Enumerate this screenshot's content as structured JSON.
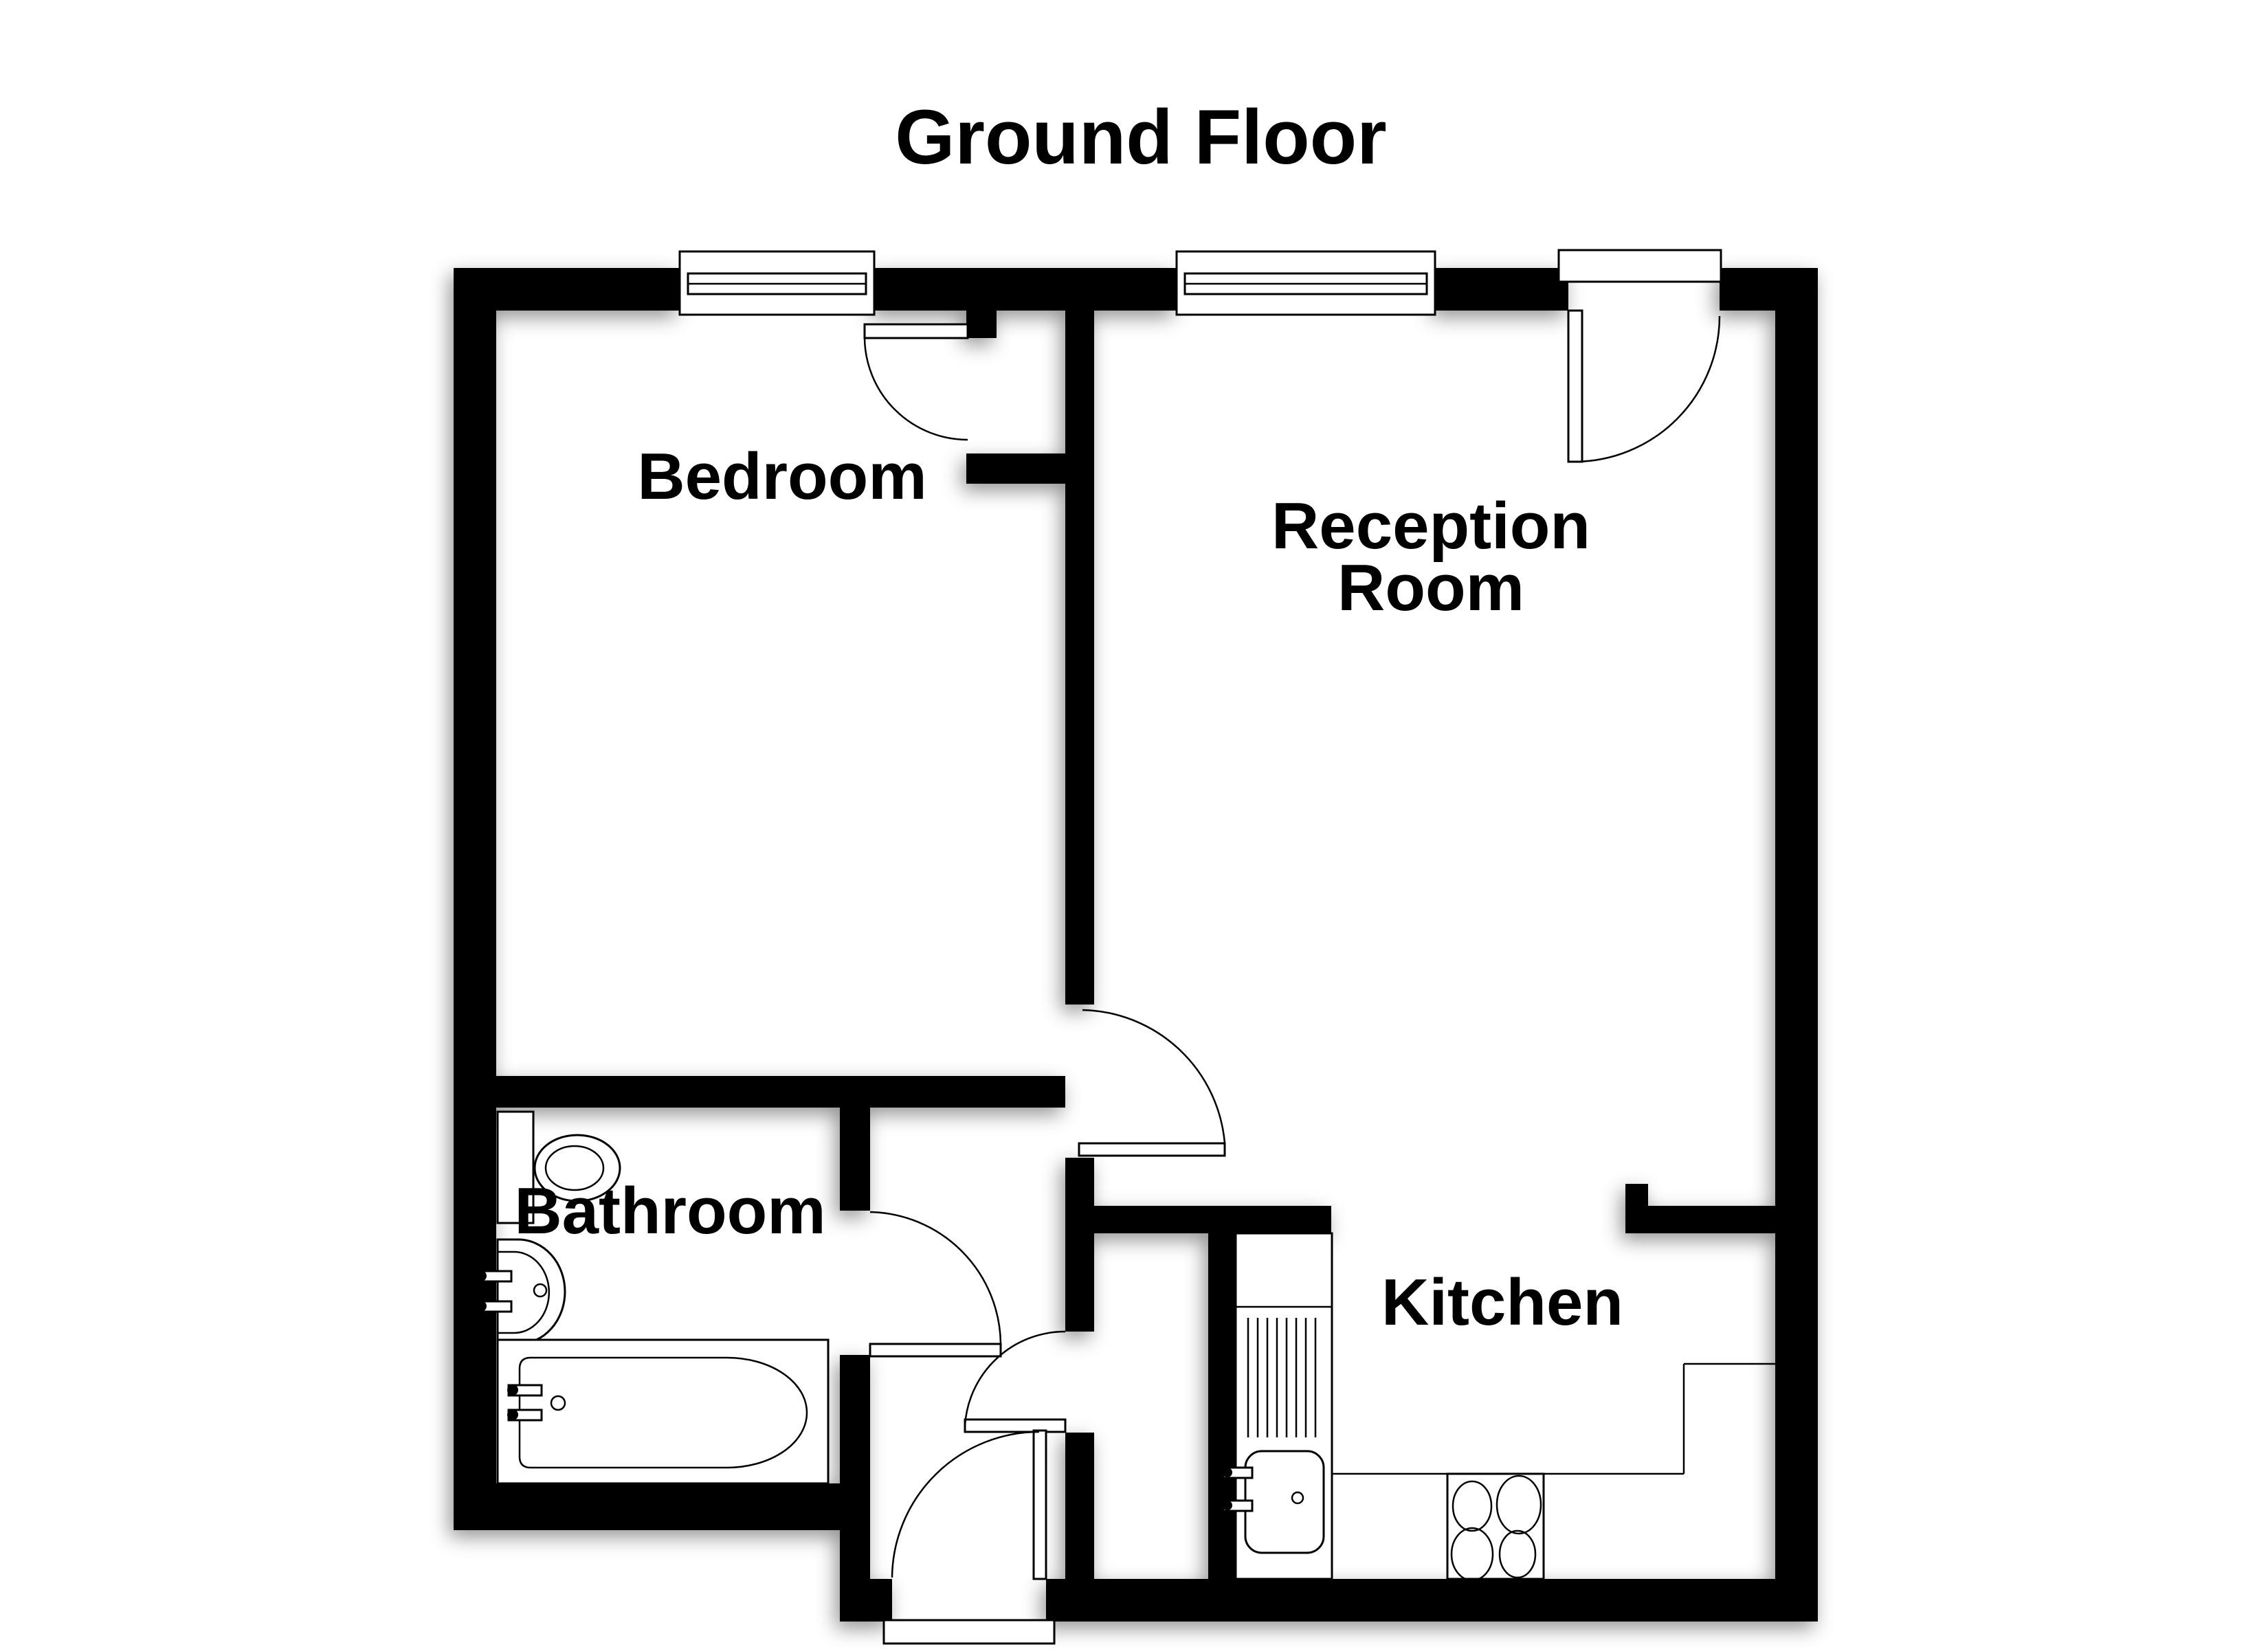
{
  "title": "Ground Floor",
  "rooms": {
    "bedroom": {
      "label": "Bedroom"
    },
    "reception": {
      "label_line1": "Reception",
      "label_line2": "Room"
    },
    "bathroom": {
      "label": "Bathroom"
    },
    "kitchen": {
      "label": "Kitchen"
    }
  },
  "colors": {
    "wall": "#000000",
    "background": "#ffffff",
    "fixture_outline": "#000000"
  }
}
